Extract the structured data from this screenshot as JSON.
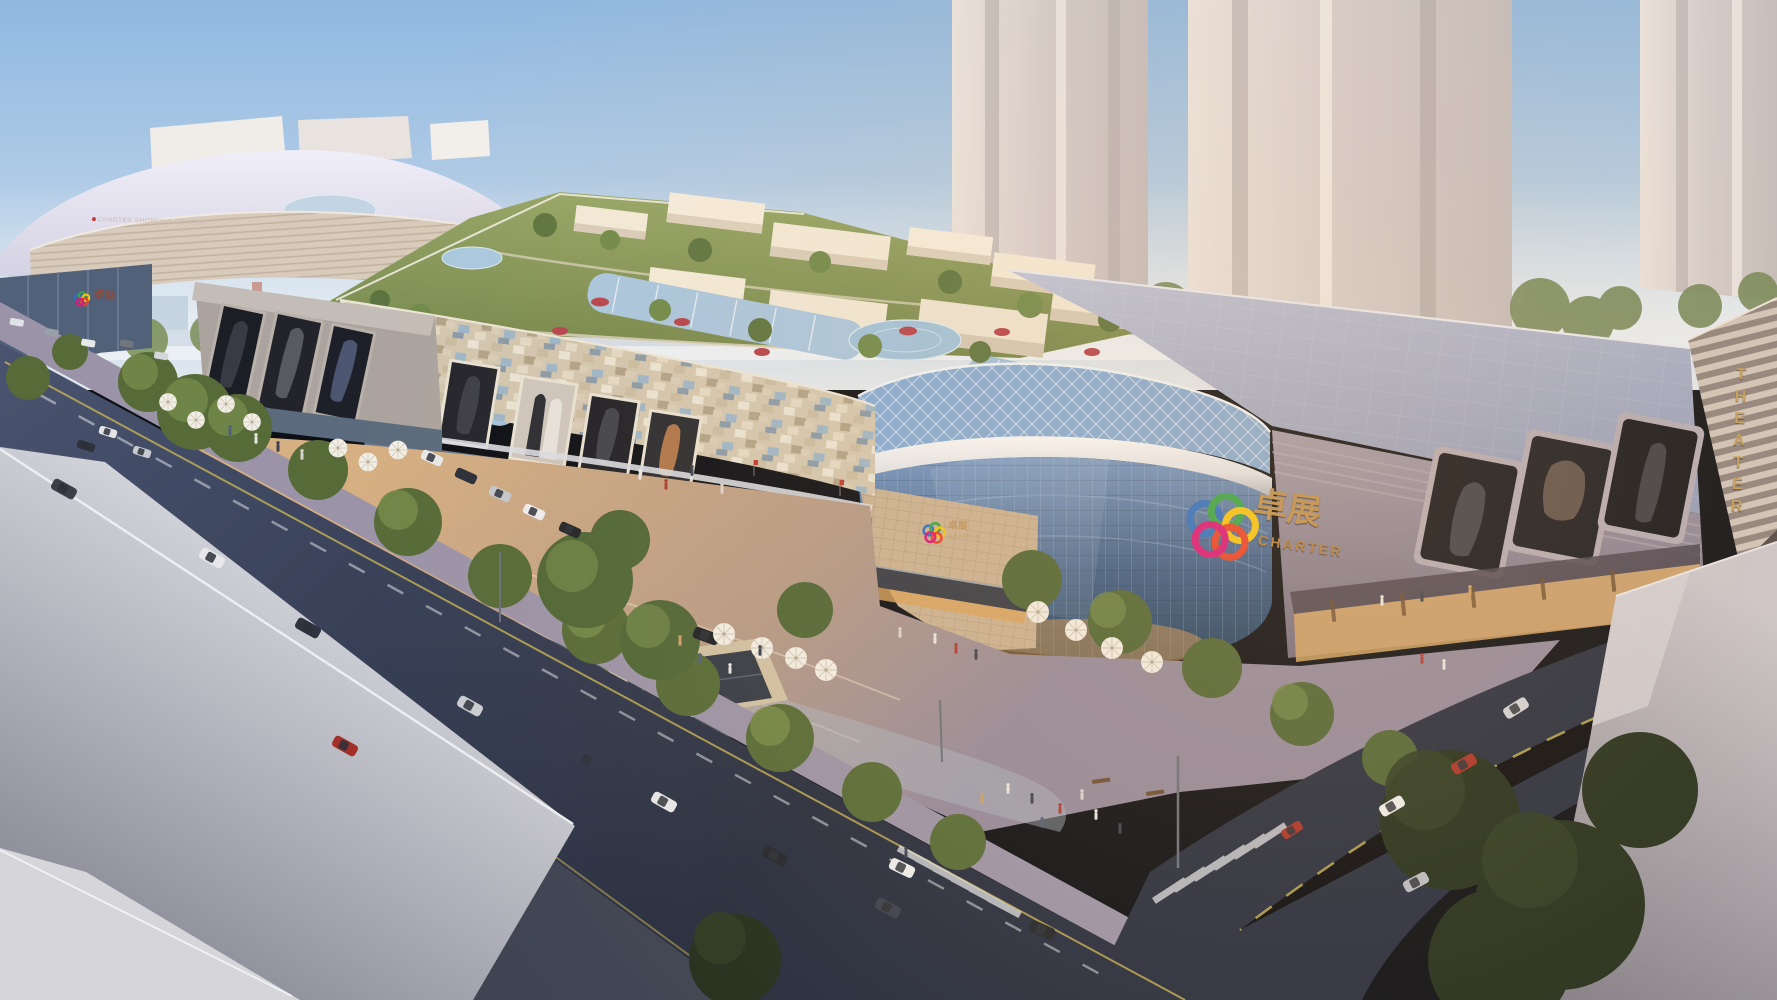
{
  "scene": {
    "description": "Aerial architectural rendering of the Charter shopping mall complex at dusk, with rooftop gardens, a curved blue-glass atrium, billboard facades, plazas, tree-lined roads and background towers"
  },
  "signs": {
    "left_building": {
      "label": "CHARTER SHOPPING CENTER"
    },
    "left_entrance": {
      "chinese": "卓展"
    },
    "atrium": {
      "chinese": "卓展",
      "latin": "CHARTER"
    },
    "entrance": {
      "chinese": "卓展",
      "latin": "CHARTER"
    },
    "theater": {
      "label": "THEATER"
    }
  },
  "palette": {
    "sky_top": "#98bee3",
    "sky_horizon": "#dde6ee",
    "glass_atrium": "#3d5d8c",
    "diagrid_blue": "#84abd6",
    "facade_beige": "#cfc3ad",
    "roof_green": "#84955a",
    "roof_right": "#a7afc9",
    "road": "#353e54",
    "plaza_warm": "#c9a87c",
    "foreground_gray": "#b4b5bf",
    "logo_gold": "#c79a5c",
    "theater_gold": "#c9a25f",
    "logo_rings": [
      "#2e6fc4",
      "#35a44b",
      "#f2c418",
      "#e6432d",
      "#d7197b"
    ]
  }
}
